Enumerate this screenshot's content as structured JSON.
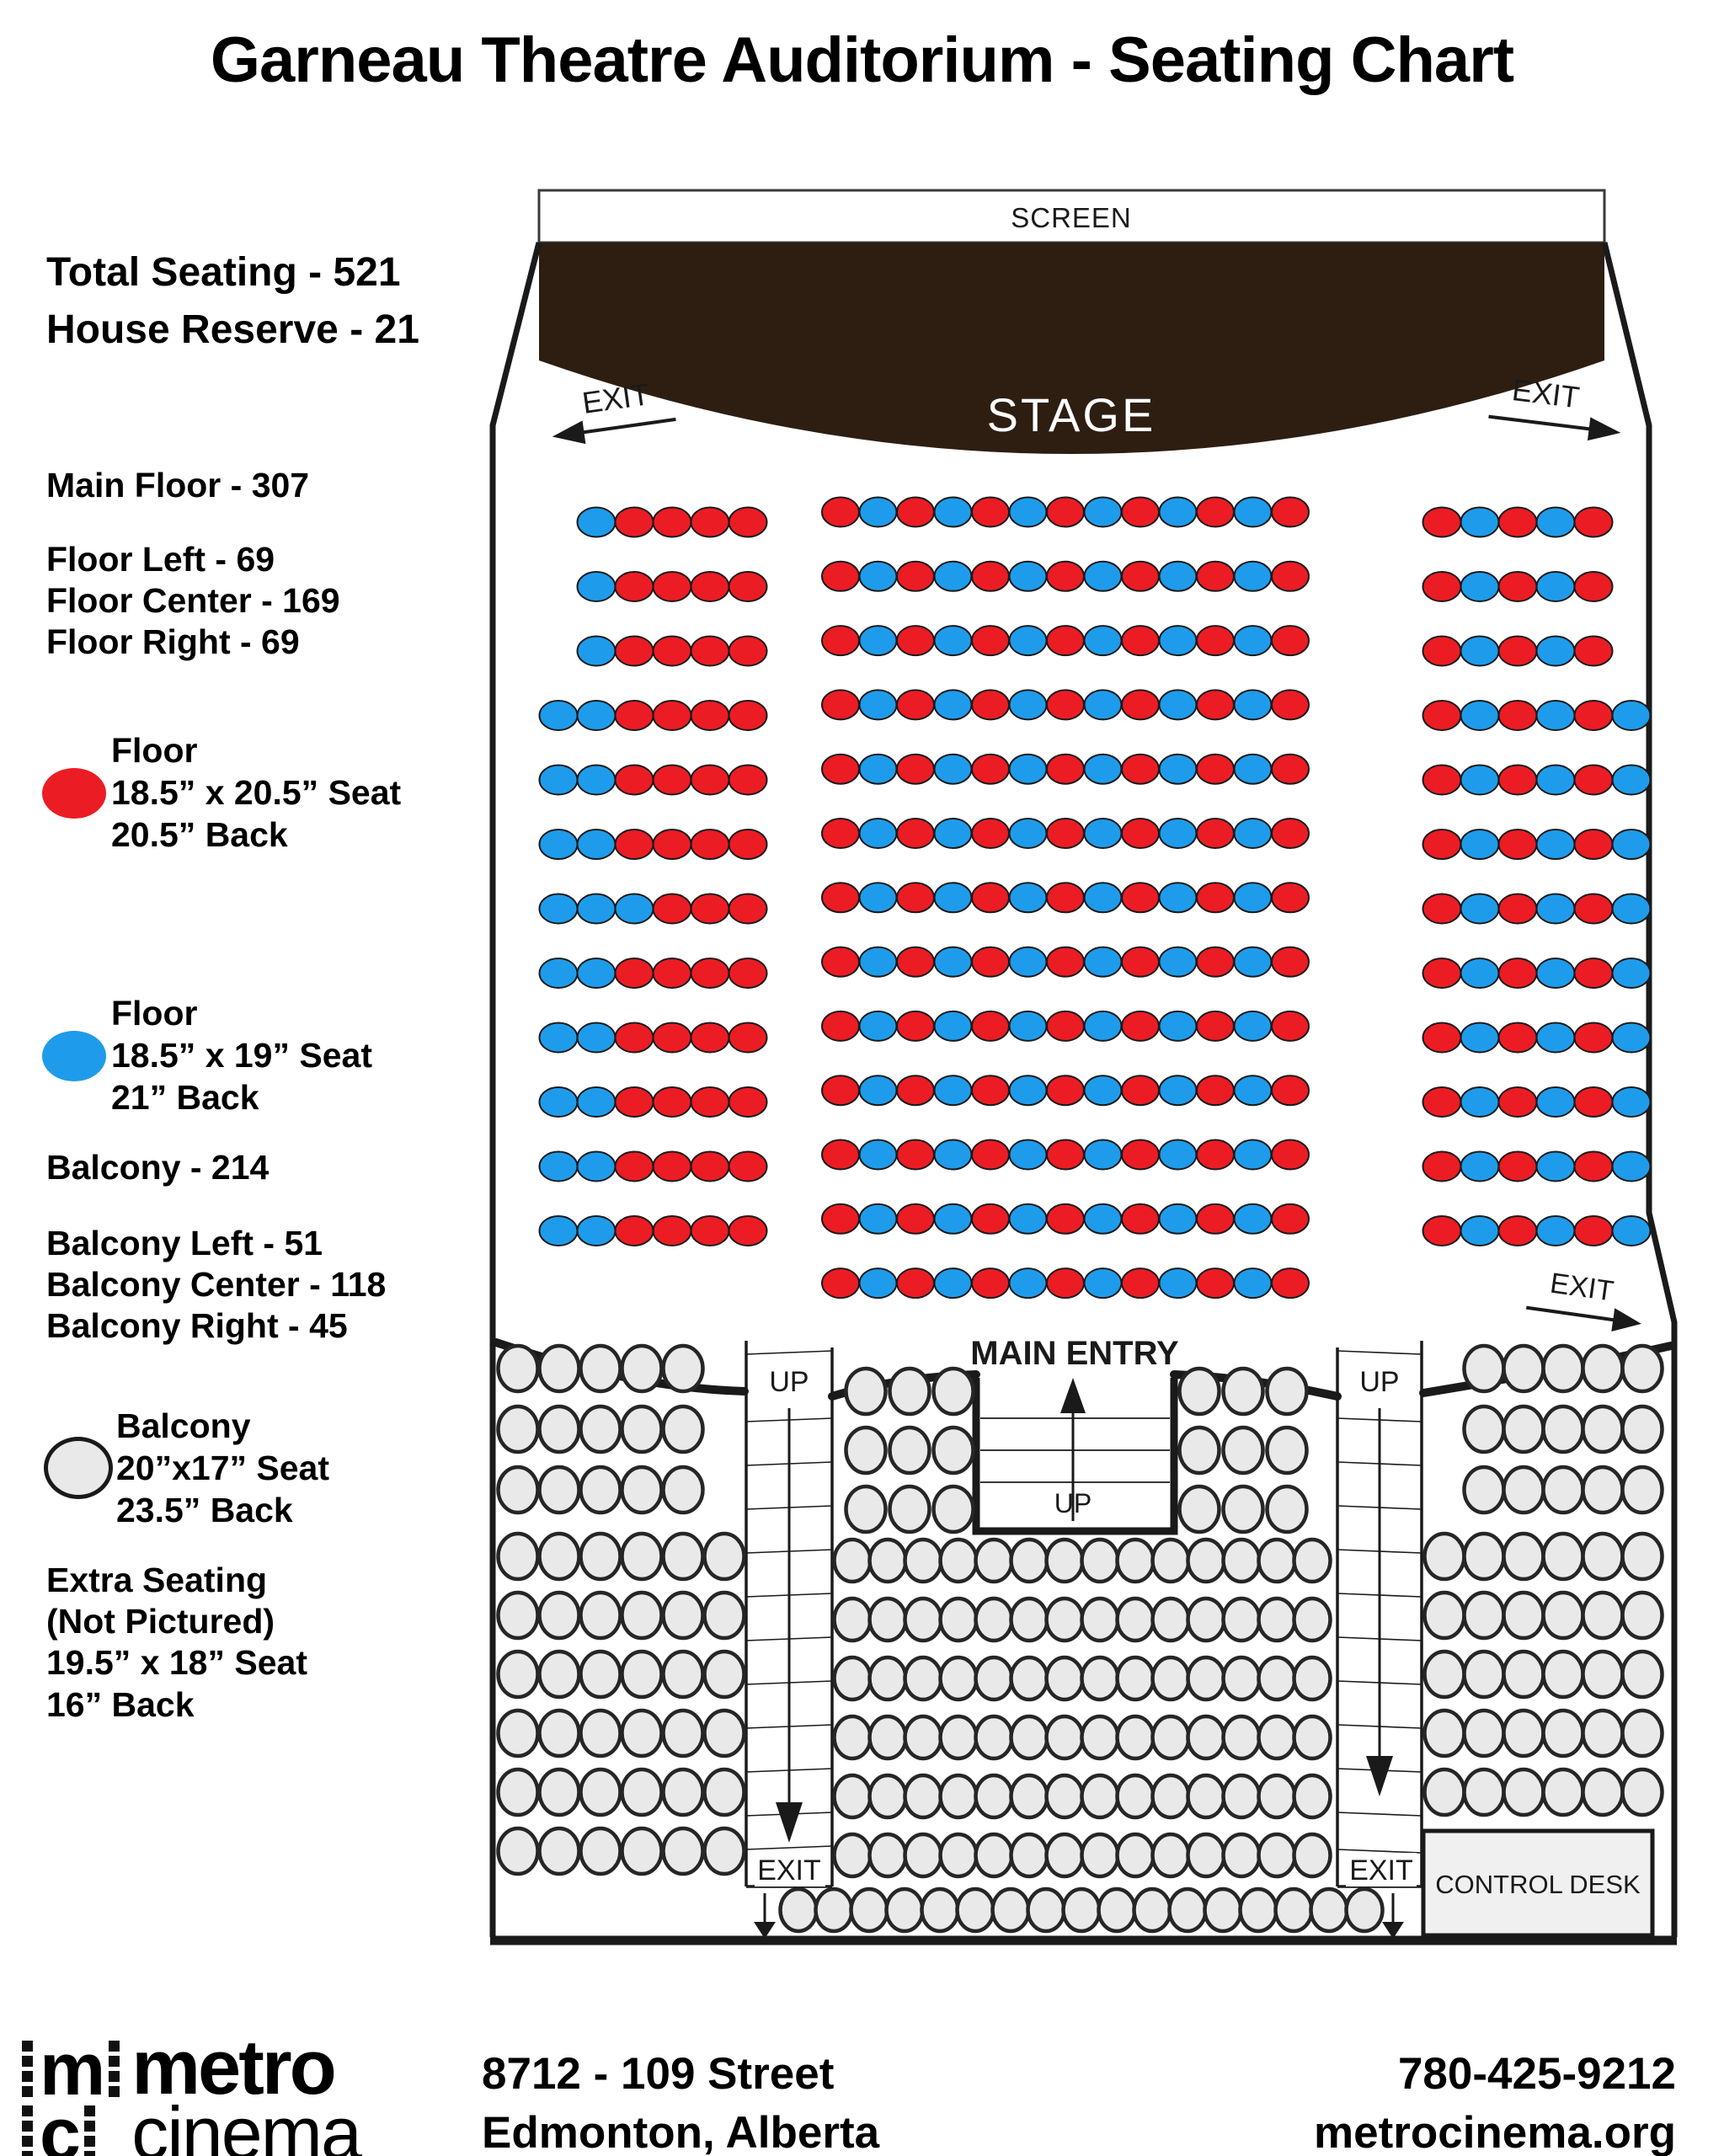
{
  "title": "Garneau Theatre Auditorium - Seating Chart",
  "sidebar": {
    "total_seating": "Total Seating - 521",
    "house_reserve": "House Reserve - 21",
    "main_floor": "Main Floor - 307",
    "floor_left": "Floor Left - 69",
    "floor_center": "Floor Center - 169",
    "floor_right": "Floor Right - 69",
    "balcony": "Balcony - 214",
    "balcony_left": "Balcony Left - 51",
    "balcony_center": "Balcony Center - 118",
    "balcony_right": "Balcony Right - 45",
    "legend_floor_red": {
      "name": "Floor",
      "line1": "18.5” x 20.5” Seat",
      "line2": "20.5” Back"
    },
    "legend_floor_blue": {
      "name": "Floor",
      "line1": "18.5” x 19” Seat",
      "line2": "21” Back"
    },
    "legend_balcony": {
      "name": "Balcony",
      "line1": "20”x17” Seat",
      "line2": "23.5” Back"
    },
    "extra_seating": {
      "line1": "Extra Seating",
      "line2": "(Not Pictured)",
      "line3": "19.5” x 18” Seat",
      "line4": "16” Back"
    }
  },
  "diagram": {
    "screen_label": "SCREEN",
    "stage_label": "STAGE",
    "exit_label": "EXIT",
    "up_label": "UP",
    "main_entry_label": "MAIN ENTRY",
    "control_desk_label": "CONTROL DESK"
  },
  "seating": {
    "colors": {
      "R": "#EC1C24",
      "B": "#1E9CEB",
      "G": "#E9E9E9",
      "floor_outline": "#1a1a1a",
      "balcony_outline": "#262626",
      "stage_fill": "#2E1E12"
    },
    "blocks": {
      "floor_left": {
        "rows": [
          {
            "indent": 1,
            "seats": "BRRRR"
          },
          {
            "indent": 1,
            "seats": "BRRRR"
          },
          {
            "indent": 1,
            "seats": "BRRRR"
          },
          {
            "indent": 0,
            "seats": "BBRRRR"
          },
          {
            "indent": 0,
            "seats": "BBRRRR"
          },
          {
            "indent": 0,
            "seats": "BBRRRR"
          },
          {
            "indent": 0,
            "seats": "BBBRRR"
          },
          {
            "indent": 0,
            "seats": "BBRRRR"
          },
          {
            "indent": 0,
            "seats": "BBRRRR"
          },
          {
            "indent": 0,
            "seats": "BBRRRR"
          },
          {
            "indent": 0,
            "seats": "BBRRRR"
          },
          {
            "indent": 0,
            "seats": "BBRRRR"
          }
        ]
      },
      "floor_center": {
        "rows": [
          {
            "indent": 0,
            "seats": "RBRBRBRBRBRBR"
          },
          {
            "indent": 0,
            "seats": "RBRBRBRBRBRBR"
          },
          {
            "indent": 0,
            "seats": "RBRBRBRBRBRBR"
          },
          {
            "indent": 0,
            "seats": "RBRBRBRBRBRBR"
          },
          {
            "indent": 0,
            "seats": "RBRBRBRBRBRBR"
          },
          {
            "indent": 0,
            "seats": "RBRBRBRBRBRBR"
          },
          {
            "indent": 0,
            "seats": "RBRBRBRBRBRBR"
          },
          {
            "indent": 0,
            "seats": "RBRBRBRBRBRBR"
          },
          {
            "indent": 0,
            "seats": "RBRBRBRBRBRBR"
          },
          {
            "indent": 0,
            "seats": "RBRBRBRBRBRBR"
          },
          {
            "indent": 0,
            "seats": "RBRBRBRBRBRBR"
          },
          {
            "indent": 0,
            "seats": "RBRBRBRBRBRBR"
          },
          {
            "indent": 0,
            "seats": "RBRBRBRBRBRBR"
          }
        ]
      },
      "floor_right": {
        "rows": [
          {
            "indent": 0,
            "seats": "RBRBR"
          },
          {
            "indent": 0,
            "seats": "RBRBR"
          },
          {
            "indent": 0,
            "seats": "RBRBR"
          },
          {
            "indent": 0,
            "seats": "RBRBRB"
          },
          {
            "indent": 0,
            "seats": "RBRBRB"
          },
          {
            "indent": 0,
            "seats": "RBRBRB"
          },
          {
            "indent": 0,
            "seats": "RBRBRB"
          },
          {
            "indent": 0,
            "seats": "RBRBRB"
          },
          {
            "indent": 0,
            "seats": "RBRBRB"
          },
          {
            "indent": 0,
            "seats": "RBRBRB"
          },
          {
            "indent": 0,
            "seats": "RBRBRB"
          },
          {
            "indent": 0,
            "seats": "RBRBRB"
          }
        ]
      },
      "balcony_left": {
        "rows": [
          {
            "indent": 0,
            "seats": "GGGGG"
          },
          {
            "indent": 0,
            "seats": "GGGGG"
          },
          {
            "indent": 0,
            "seats": "GGGGG"
          },
          {
            "indent": 0,
            "seats": "GGGGGG"
          },
          {
            "indent": 0,
            "seats": "GGGGGG"
          },
          {
            "indent": 0,
            "seats": "GGGGGG"
          },
          {
            "indent": 0,
            "seats": "GGGGGG"
          },
          {
            "indent": 0,
            "seats": "GGGGGG"
          },
          {
            "indent": 0,
            "seats": "GGGGGG"
          }
        ]
      },
      "balcony_center_flank_left": {
        "rows": [
          {
            "indent": 0,
            "seats": "GGG"
          },
          {
            "indent": 0,
            "seats": "GGG"
          },
          {
            "indent": 0,
            "seats": "GGG"
          }
        ]
      },
      "balcony_center_flank_right": {
        "rows": [
          {
            "indent": 0,
            "seats": "GGG"
          },
          {
            "indent": 0,
            "seats": "GGG"
          },
          {
            "indent": 0,
            "seats": "GGG"
          }
        ]
      },
      "balcony_center_main": {
        "rows": [
          {
            "indent": 0,
            "seats": "GGGGGGGGGGGGGG"
          },
          {
            "indent": 0,
            "seats": "GGGGGGGGGGGGGG"
          },
          {
            "indent": 0,
            "seats": "GGGGGGGGGGGGGG"
          },
          {
            "indent": 0,
            "seats": "GGGGGGGGGGGGGG"
          },
          {
            "indent": 0,
            "seats": "GGGGGGGGGGGGGG"
          },
          {
            "indent": 0,
            "seats": "GGGGGGGGGGGGGG"
          }
        ]
      },
      "balcony_center_bottom": {
        "rows": [
          {
            "indent": 0,
            "seats": "GGGGGGGGGGGGGGGGG"
          }
        ]
      },
      "balcony_right": {
        "rows": [
          {
            "indent": 1,
            "seats": "GGGGG"
          },
          {
            "indent": 1,
            "seats": "GGGGG"
          },
          {
            "indent": 1,
            "seats": "GGGGG"
          },
          {
            "indent": 0,
            "seats": "GGGGGG"
          },
          {
            "indent": 0,
            "seats": "GGGGGG"
          },
          {
            "indent": 0,
            "seats": "GGGGGG"
          },
          {
            "indent": 0,
            "seats": "GGGGGG"
          },
          {
            "indent": 0,
            "seats": "GGGGGG"
          }
        ]
      }
    }
  },
  "footer": {
    "logo_line1": "metro",
    "logo_line2": "cinema",
    "address_line1": "8712 - 109 Street",
    "address_line2": "Edmonton, Alberta",
    "phone": "780-425-9212",
    "website": "metrocinema.org"
  }
}
